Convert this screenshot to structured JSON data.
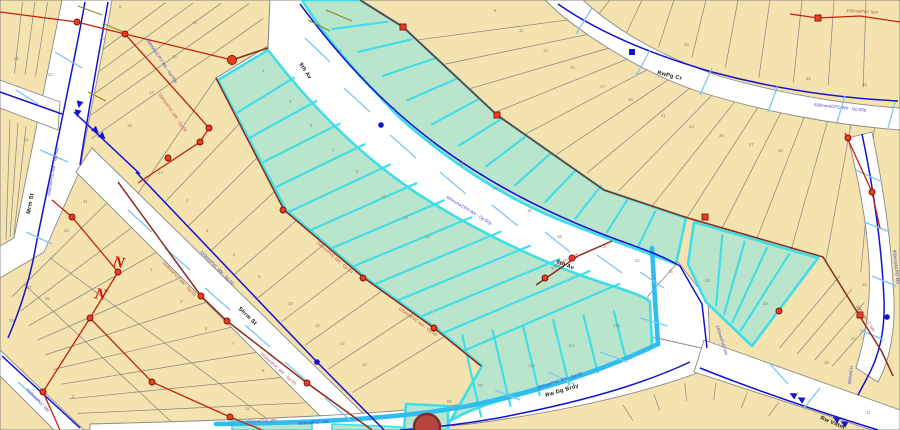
{
  "map": {
    "colors": {
      "parcel_fill": "#f4e2af",
      "parcel_border": "#85857d",
      "selected_fill": "#b9e5cd",
      "selected_border": "#3edde8",
      "street_fill": "#ffffff",
      "water_main": "#1212cf",
      "service_line": "#7fc6ee",
      "highlight_main": "#2fbdf0",
      "sewer_red": "#c22209",
      "force_maroon": "#8a2a1a",
      "node_red": "#ee3c1e",
      "olive_line": "#8b8b1e",
      "street_text": "#16160f",
      "parcel_text": "#8b8874",
      "pipe_text_blue": "#4444cd",
      "pipe_text_red": "#bb5050",
      "selected_marker_fill": "#b5453c",
      "selected_marker_ring": "#7e2d28"
    },
    "street_labels": [
      {
        "text": "9th Av",
        "x": 299,
        "y": 64,
        "rot": 57
      },
      {
        "text": "9th Av",
        "x": 556,
        "y": 263,
        "rot": 21
      },
      {
        "text": "RwPg Cr",
        "x": 657,
        "y": 74,
        "rot": 14
      },
      {
        "text": "Shrm St",
        "x": 238,
        "y": 309,
        "rot": 44
      },
      {
        "text": "Mrm St",
        "x": 30,
        "y": 214,
        "rot": -80
      },
      {
        "text": "Rw Dg Brdy",
        "x": 546,
        "y": 397,
        "rot": -17
      },
      {
        "text": "Rw Vdtm",
        "x": 820,
        "y": 419,
        "rot": 23
      }
    ],
    "pipe_labels": [
      {
        "text": "600mmPVC Wtr - Gp:50p",
        "x": 50,
        "y": 196,
        "rot": -80,
        "c": "blue"
      },
      {
        "text": "600mmACPO Wtr - Gp:50p",
        "x": 146,
        "y": 40,
        "rot": 56,
        "c": "blue"
      },
      {
        "text": "600mmACPO Wtr - Gp:50p",
        "x": 446,
        "y": 198,
        "rot": 31,
        "c": "blue"
      },
      {
        "text": "600mmACPO Wtr - Gp:50p",
        "x": 814,
        "y": 106,
        "rot": 6,
        "c": "blue"
      },
      {
        "text": "300mmPVC Wtr - Gp:50",
        "x": 538,
        "y": 389,
        "rot": -18,
        "c": "blue"
      },
      {
        "text": "300mmPVC Wtr",
        "x": 298,
        "y": 425,
        "rot": -4,
        "c": "blue"
      },
      {
        "text": "BRANCH",
        "x": 851,
        "y": 384,
        "rot": -84,
        "c": "blue"
      },
      {
        "text": "150mmPVC Wtr",
        "x": 716,
        "y": 326,
        "rot": 73,
        "c": "blue"
      },
      {
        "text": "600mmACPO Wtr",
        "x": 893,
        "y": 250,
        "rot": 84,
        "c": "blue"
      },
      {
        "text": "150mmPVC Wtr - Gp:50",
        "x": 200,
        "y": 252,
        "rot": 46,
        "c": "blue"
      },
      {
        "text": "600mmPVC Wtr",
        "x": 26,
        "y": 390,
        "rot": 46,
        "c": "blue"
      },
      {
        "text": "150mmPVC Wtr - Gp:50",
        "x": 158,
        "y": 94,
        "rot": 55,
        "c": "red"
      },
      {
        "text": "150mmPVC Wtr - Gp:50",
        "x": 316,
        "y": 243,
        "rot": 41,
        "c": "red"
      },
      {
        "text": "150mmPVC Wtr - Gp:50",
        "x": 398,
        "y": 309,
        "rot": 36,
        "c": "red"
      },
      {
        "text": "150mmPVC Wtr - Gp:50",
        "x": 162,
        "y": 263,
        "rot": 46,
        "c": "red"
      },
      {
        "text": "150mmPVC Wtr - Gp:50",
        "x": 260,
        "y": 354,
        "rot": 42,
        "c": "red"
      },
      {
        "text": "150mmPVC San",
        "x": 846,
        "y": 12,
        "rot": 3,
        "c": "red"
      },
      {
        "text": "150mmPVC Wtr",
        "x": 856,
        "y": 306,
        "rot": 57,
        "c": "red"
      },
      {
        "text": "150mmPVC Wtr",
        "x": 246,
        "y": 423,
        "rot": -3,
        "c": "red"
      },
      {
        "text": "100mmPVC Wtr",
        "x": 552,
        "y": 270,
        "rot": -29,
        "c": "red"
      }
    ],
    "parcel_numbers": [
      {
        "text": "30",
        "x": 14,
        "y": 60
      },
      {
        "text": "32",
        "x": 48,
        "y": 76
      },
      {
        "text": "8",
        "x": 119,
        "y": 8
      },
      {
        "text": "10",
        "x": 101,
        "y": 40
      },
      {
        "text": "13",
        "x": 192,
        "y": 24
      },
      {
        "text": "15",
        "x": 172,
        "y": 58
      },
      {
        "text": "17",
        "x": 149,
        "y": 94
      },
      {
        "text": "19",
        "x": 127,
        "y": 127
      },
      {
        "text": "11",
        "x": 24,
        "y": 141
      },
      {
        "text": "21",
        "x": 83,
        "y": 203
      },
      {
        "text": "23",
        "x": 64,
        "y": 232
      },
      {
        "text": "27",
        "x": 27,
        "y": 289
      },
      {
        "text": "26",
        "x": 45,
        "y": 300
      },
      {
        "text": "28",
        "x": 9,
        "y": 322
      },
      {
        "text": "1",
        "x": 150,
        "y": 271
      },
      {
        "text": "3",
        "x": 180,
        "y": 303
      },
      {
        "text": "5",
        "x": 205,
        "y": 330
      },
      {
        "text": "7",
        "x": 232,
        "y": 345
      },
      {
        "text": "9",
        "x": 262,
        "y": 372
      },
      {
        "text": "11",
        "x": 245,
        "y": 410
      },
      {
        "text": "2",
        "x": 72,
        "y": 398
      },
      {
        "text": "2A",
        "x": 158,
        "y": 174
      },
      {
        "text": "2",
        "x": 186,
        "y": 202
      },
      {
        "text": "4",
        "x": 206,
        "y": 232
      },
      {
        "text": "6",
        "x": 233,
        "y": 256
      },
      {
        "text": "8",
        "x": 258,
        "y": 278
      },
      {
        "text": "10",
        "x": 288,
        "y": 305
      },
      {
        "text": "12",
        "x": 315,
        "y": 327
      },
      {
        "text": "14",
        "x": 340,
        "y": 345
      },
      {
        "text": "16",
        "x": 362,
        "y": 366
      },
      {
        "text": "1",
        "x": 262,
        "y": 72
      },
      {
        "text": "3",
        "x": 289,
        "y": 103
      },
      {
        "text": "5",
        "x": 310,
        "y": 127
      },
      {
        "text": "7",
        "x": 332,
        "y": 152
      },
      {
        "text": "9",
        "x": 356,
        "y": 173
      },
      {
        "text": "11",
        "x": 381,
        "y": 198
      },
      {
        "text": "13",
        "x": 403,
        "y": 219
      },
      {
        "text": "15",
        "x": 425,
        "y": 238
      },
      {
        "text": "4",
        "x": 339,
        "y": 52
      },
      {
        "text": "6",
        "x": 363,
        "y": 80
      },
      {
        "text": "8",
        "x": 393,
        "y": 110
      },
      {
        "text": "10",
        "x": 428,
        "y": 142
      },
      {
        "text": "12",
        "x": 459,
        "y": 165
      },
      {
        "text": "14",
        "x": 492,
        "y": 190
      },
      {
        "text": "16",
        "x": 527,
        "y": 212
      },
      {
        "text": "18",
        "x": 557,
        "y": 238
      },
      {
        "text": "20",
        "x": 602,
        "y": 248
      },
      {
        "text": "22",
        "x": 635,
        "y": 262
      },
      {
        "text": "24",
        "x": 668,
        "y": 273
      },
      {
        "text": "26",
        "x": 705,
        "y": 282
      },
      {
        "text": "28",
        "x": 763,
        "y": 305
      },
      {
        "text": "116",
        "x": 613,
        "y": 327
      },
      {
        "text": "114",
        "x": 568,
        "y": 347
      },
      {
        "text": "112",
        "x": 528,
        "y": 367
      },
      {
        "text": "78",
        "x": 478,
        "y": 387
      },
      {
        "text": "98",
        "x": 447,
        "y": 403
      },
      {
        "text": "9",
        "x": 494,
        "y": 12
      },
      {
        "text": "11",
        "x": 519,
        "y": 32
      },
      {
        "text": "13",
        "x": 543,
        "y": 52
      },
      {
        "text": "15",
        "x": 570,
        "y": 69
      },
      {
        "text": "17",
        "x": 600,
        "y": 88
      },
      {
        "text": "19",
        "x": 628,
        "y": 101
      },
      {
        "text": "21",
        "x": 661,
        "y": 117
      },
      {
        "text": "23",
        "x": 689,
        "y": 128
      },
      {
        "text": "25",
        "x": 719,
        "y": 137
      },
      {
        "text": "27",
        "x": 749,
        "y": 146
      },
      {
        "text": "29",
        "x": 778,
        "y": 152
      },
      {
        "text": "10",
        "x": 862,
        "y": 286
      },
      {
        "text": "12",
        "x": 856,
        "y": 310
      },
      {
        "text": "14",
        "x": 850,
        "y": 340
      },
      {
        "text": "16",
        "x": 824,
        "y": 364
      },
      {
        "text": "24",
        "x": 684,
        "y": 46
      },
      {
        "text": "32",
        "x": 806,
        "y": 80
      },
      {
        "text": "34",
        "x": 862,
        "y": 86
      },
      {
        "text": "11",
        "x": 866,
        "y": 414
      }
    ],
    "nodes_red": [
      [
        77,
        22
      ],
      [
        125,
        34
      ],
      [
        232,
        60,
        4.5
      ],
      [
        209,
        128
      ],
      [
        200,
        142
      ],
      [
        168,
        158
      ],
      [
        283,
        210
      ],
      [
        363,
        278
      ],
      [
        434,
        328
      ],
      [
        545,
        278
      ],
      [
        572,
        258
      ],
      [
        201,
        296
      ],
      [
        227,
        321
      ],
      [
        307,
        383
      ],
      [
        72,
        217
      ],
      [
        118,
        272
      ],
      [
        90,
        318
      ],
      [
        152,
        382
      ],
      [
        230,
        417
      ],
      [
        43,
        392
      ],
      [
        848,
        138
      ],
      [
        872,
        192
      ],
      [
        779,
        311
      ]
    ],
    "squares_red": [
      [
        403,
        27
      ],
      [
        497,
        115
      ],
      [
        705,
        217
      ],
      [
        860,
        315
      ],
      [
        818,
        18
      ]
    ],
    "nodes_blue": [
      [
        381,
        125
      ],
      [
        317,
        362
      ],
      [
        887,
        317
      ]
    ],
    "squares_blue": [
      [
        632,
        52
      ]
    ],
    "flow_arrows": [
      {
        "x": 78,
        "y": 111,
        "rot": 102
      },
      {
        "x": 101,
        "y": 135,
        "rot": 42
      },
      {
        "x": 795,
        "y": 396,
        "rot": 208
      },
      {
        "x": 838,
        "y": 420,
        "rot": 208
      }
    ],
    "annotation_letters": [
      {
        "text": "N",
        "x": 112,
        "y": 266,
        "rot": 12
      },
      {
        "text": "N",
        "x": 94,
        "y": 298,
        "rot": 12
      }
    ],
    "selected_marker": {
      "x": 427,
      "y": 427,
      "r": 13
    }
  }
}
